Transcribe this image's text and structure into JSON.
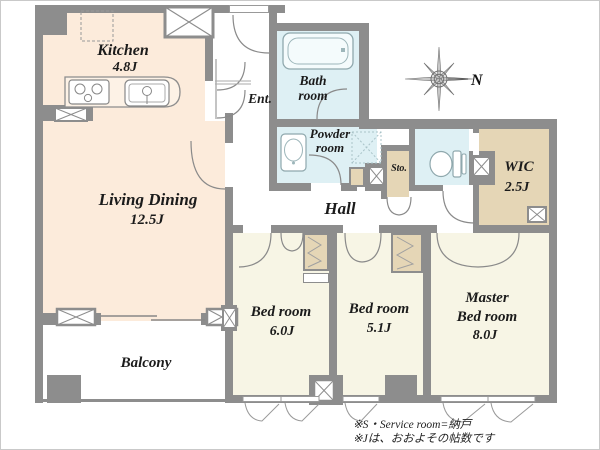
{
  "rooms": {
    "kitchen": {
      "name": "Kitchen",
      "size": "4.8J"
    },
    "living_dining": {
      "name": "Living Dining",
      "size": "12.5J"
    },
    "balcony": {
      "name": "Balcony"
    },
    "entrance": {
      "name": "Ent."
    },
    "bathroom": {
      "line1": "Bath",
      "line2": "room"
    },
    "powder_room": {
      "line1": "Powder",
      "line2": "room"
    },
    "hall": {
      "name": "Hall"
    },
    "storage": {
      "name": "Sto."
    },
    "wic": {
      "name": "WIC",
      "size": "2.5J"
    },
    "bedroom_1": {
      "name": "Bed room",
      "size": "6.0J"
    },
    "bedroom_2": {
      "name": "Bed room",
      "size": "5.1J"
    },
    "master_bedroom": {
      "line1": "Master",
      "line2": "Bed room",
      "size": "8.0J"
    }
  },
  "compass": {
    "north_label": "N"
  },
  "notes": {
    "line1": "※S・Service room=納戸",
    "line2": "※Jは、おおよその帖数です"
  },
  "colors": {
    "room_peach": "#fcebdb",
    "room_blue": "#def0f4",
    "room_cream": "#f7f5e5",
    "room_tan": "#e5d6b6",
    "wall_gray": "#8d8d8d"
  }
}
